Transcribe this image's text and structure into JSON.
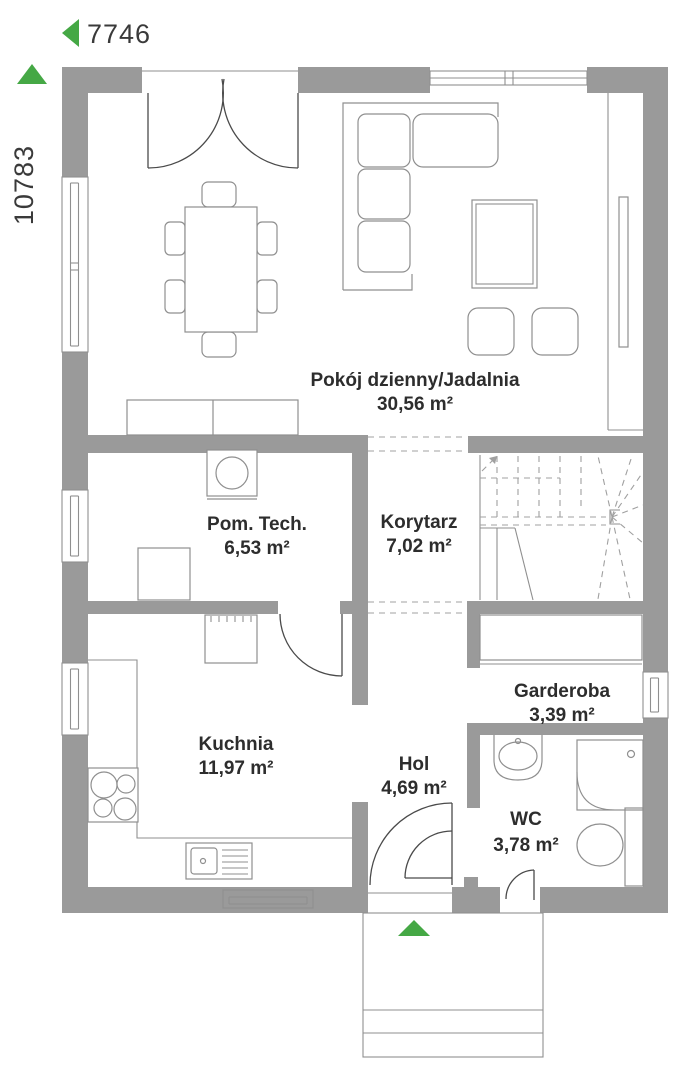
{
  "dimensions": {
    "width_label": "7746",
    "height_label": "10783"
  },
  "rooms": [
    {
      "name": "Pokój dzienny/Jadalnia",
      "area": "30,56 m²"
    },
    {
      "name": "Pom. Tech.",
      "area": "6,53 m²"
    },
    {
      "name": "Korytarz",
      "area": "7,02 m²"
    },
    {
      "name": "Kuchnia",
      "area": "11,97 m²"
    },
    {
      "name": "Garderoba",
      "area": "3,39 m²"
    },
    {
      "name": "Hol",
      "area": "4,69 m²"
    },
    {
      "name": "WC",
      "area": "3,78 m²"
    }
  ],
  "colors": {
    "wall": "#9a9a9a",
    "line": "#4a4a4a",
    "furniture": "#8f8f8f",
    "dash": "#a0a0a0",
    "accent_green": "#45a845",
    "text": "#2d2d2d",
    "dim_text": "#3a3a3a"
  }
}
